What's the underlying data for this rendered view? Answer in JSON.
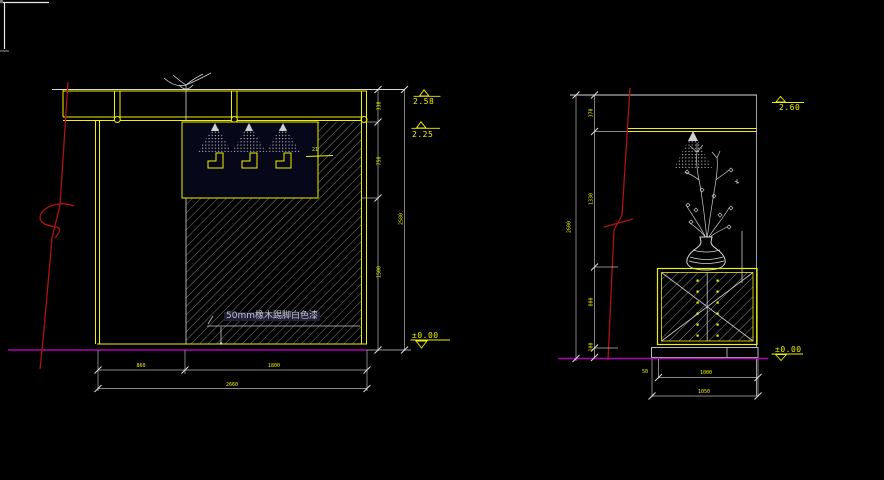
{
  "drawing": {
    "type": "interior-elevation-cad",
    "background": "#000000",
    "palette": {
      "entity_yellow": "#f2f200",
      "line_white": "#d8d8d8",
      "hatch_grey": "#98a0a0",
      "break_red": "#b01212",
      "floor_magenta": "#b000b0",
      "dim_text": "#f2f200",
      "note_text": "#c9c9c9"
    }
  },
  "left_elevation": {
    "title": "wall-elevation-with-spotlights",
    "level_upper": "2.58",
    "level_mid": "2.25",
    "level_floor": "±0.00",
    "skirting_note": "50mm橡木踢脚白色漆",
    "callout": "21",
    "dims": {
      "v1": "330",
      "v2": "750",
      "v3": "1500",
      "v_total": "2580",
      "h1": "860",
      "h2": "1800",
      "h_total": "2660"
    }
  },
  "right_elevation": {
    "title": "cabinet-elevation-with-vase",
    "level_upper": "2.60",
    "level_floor": "±0.00",
    "dims": {
      "v1": "370",
      "v2": "1330",
      "v3": "800",
      "v4": "100",
      "v_total": "2600",
      "w_cabinet": "1000",
      "w_plinth": "1050",
      "offset": "50"
    }
  }
}
